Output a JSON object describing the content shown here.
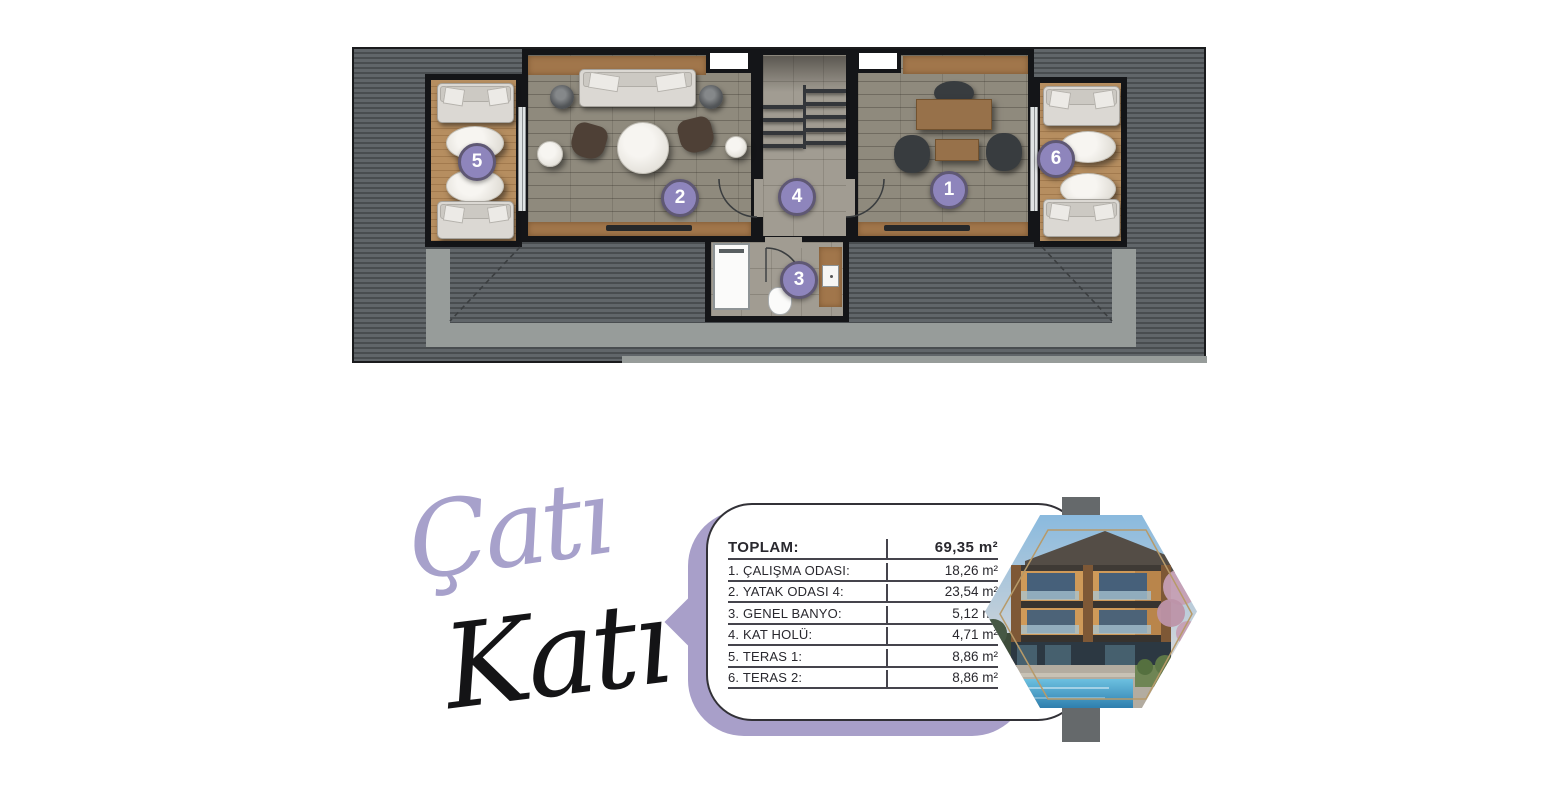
{
  "floor_title": {
    "line1": "Çatı",
    "line2": "Katı"
  },
  "floor_plan": {
    "badges": [
      "1",
      "2",
      "3",
      "4",
      "5",
      "6"
    ]
  },
  "area_table": {
    "rows": [
      {
        "label": "TOPLAM:",
        "value": "69,35 m²"
      },
      {
        "label": "1. ÇALIŞMA ODASI:",
        "value": "18,26 m²"
      },
      {
        "label": "2. YATAK ODASI 4:",
        "value": "23,54 m²"
      },
      {
        "label": "3. GENEL BANYO:",
        "value": "5,12 m²"
      },
      {
        "label": "4. KAT HOLÜ:",
        "value": "4,71 m²"
      },
      {
        "label": "5. TERAS 1:",
        "value": "8,86 m²"
      },
      {
        "label": "6. TERAS 2:",
        "value": "8,86 m²"
      }
    ]
  },
  "colors": {
    "badge_purple": "#8e85bc",
    "card_purple": "#a89fc9",
    "roof_gray": "#5f6467",
    "deck_wood": "#b68e60"
  }
}
